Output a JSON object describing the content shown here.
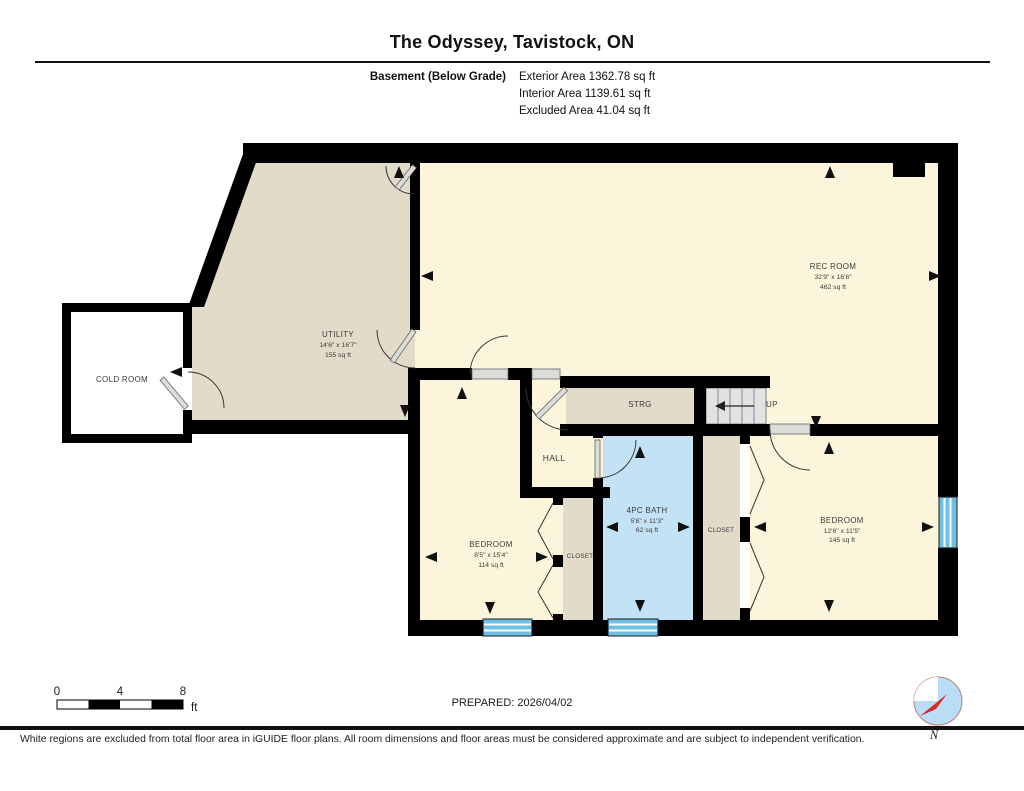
{
  "header": {
    "title": "The Odyssey, Tavistock, ON",
    "floor_label": "Basement (Below Grade)",
    "areas": [
      "Exterior Area 1362.78 sq ft",
      "Interior Area 1139.61 sq ft",
      "Excluded Area 41.04 sq ft"
    ]
  },
  "rooms": {
    "cold_room": {
      "name": "COLD ROOM"
    },
    "utility": {
      "name": "UTILITY",
      "dims": "14'6\" x 16'7\"",
      "area": "155 sq ft"
    },
    "rec_room": {
      "name": "REC ROOM",
      "dims": "32'9\" x 16'6\"",
      "area": "462 sq ft"
    },
    "strg": {
      "name": "STRG"
    },
    "stairs": {
      "label": "UP"
    },
    "hall": {
      "name": "HALL"
    },
    "bedroom1": {
      "name": "BEDROOM",
      "dims": "8'5\" x 15'4\"",
      "area": "114 sq ft"
    },
    "closet1": {
      "name": "CLOSET"
    },
    "bath": {
      "name": "4PC BATH",
      "dims": "5'6\" x 11'3\"",
      "area": "62 sq ft"
    },
    "closet2": {
      "name": "CLOSET"
    },
    "bedroom2": {
      "name": "BEDROOM",
      "dims": "12'6\" x 11'5\"",
      "area": "145 sq ft"
    }
  },
  "scale_bar": {
    "ticks": [
      "0",
      "4",
      "8"
    ],
    "unit": "ft"
  },
  "footer": {
    "prepared": "PREPARED: 2026/04/02",
    "compass_label": "N",
    "disclaimer": "White regions are excluded from total floor area in iGUIDE floor plans. All room dimensions and floor areas must be considered approximate and are subject to independent verification."
  },
  "colors": {
    "room_cream": "#FCF5DB",
    "room_tan": "#E3DBC9",
    "bath_blue": "#C3E2F5",
    "stairs_gray": "#E2E2E2",
    "window_blue": "#6FBEE4",
    "wall_black": "#000000",
    "compass_blue": "#B9DDF5",
    "compass_red": "#D42A2A"
  }
}
